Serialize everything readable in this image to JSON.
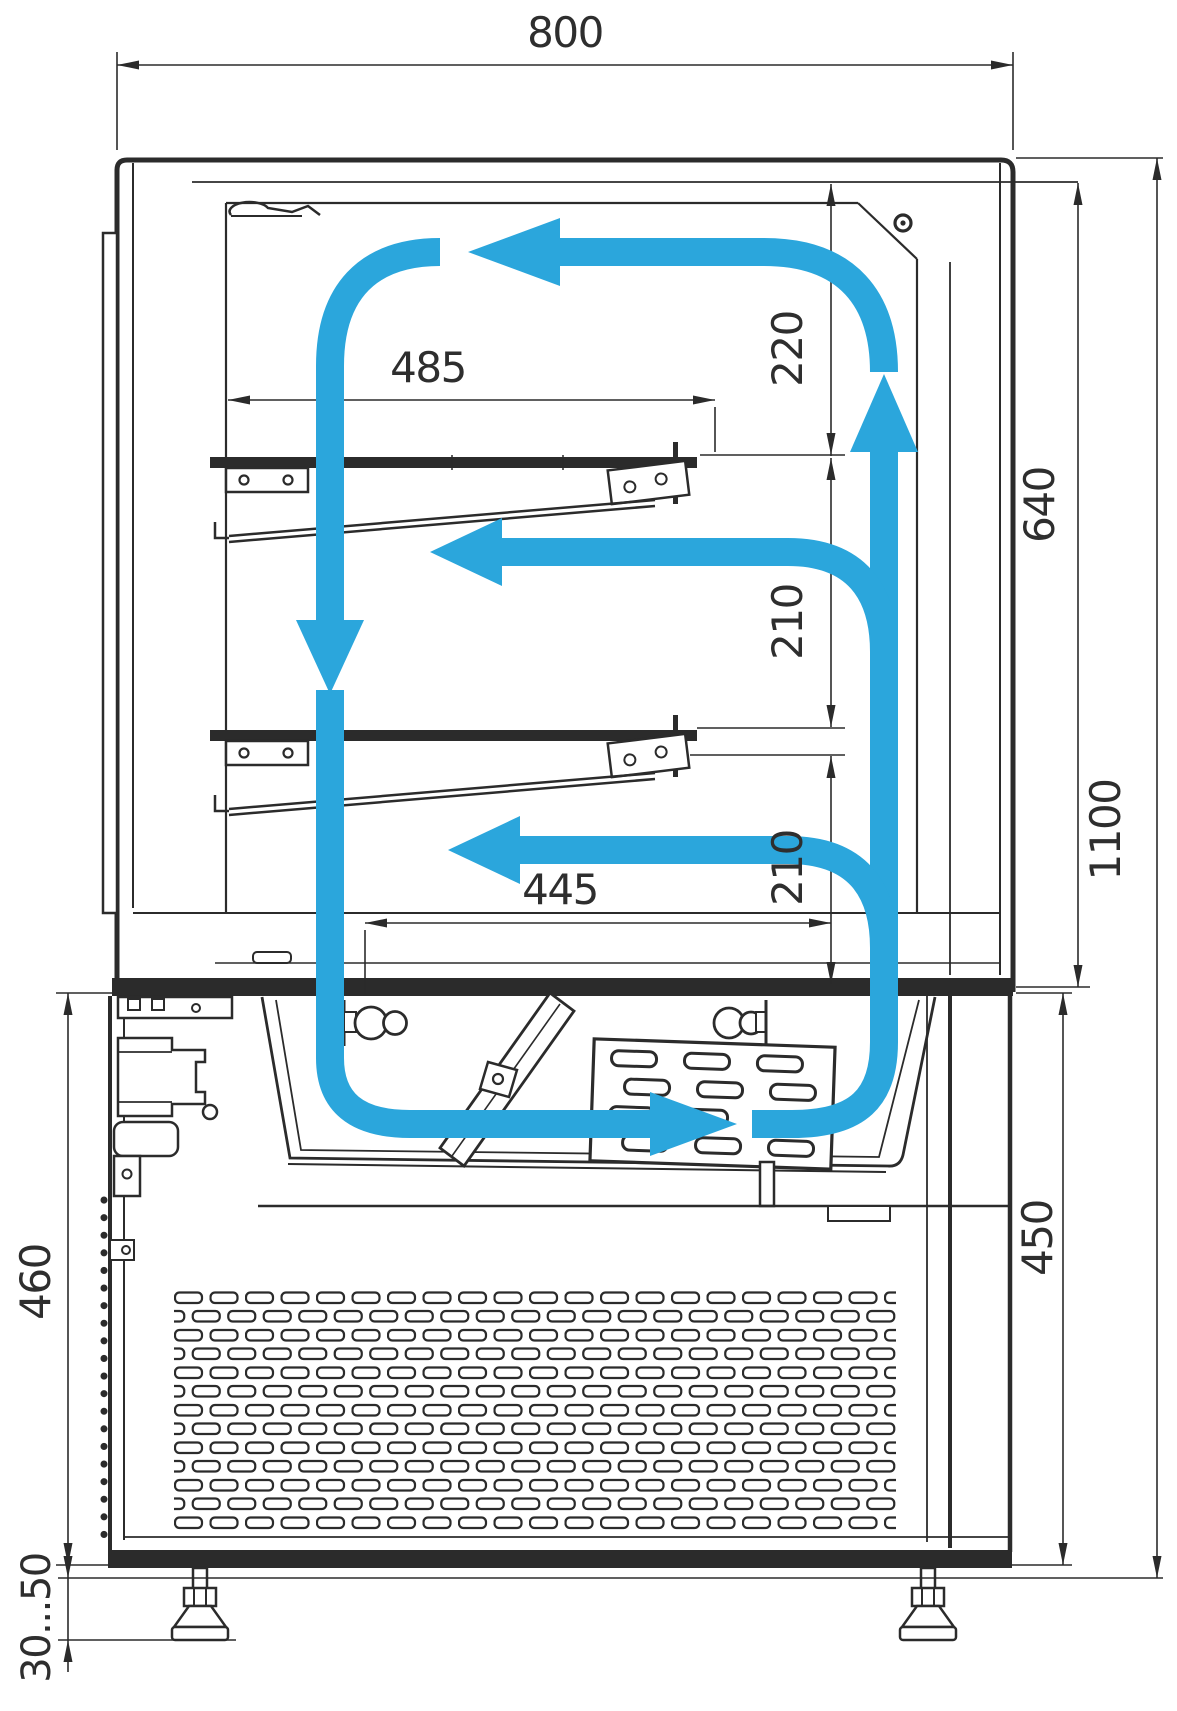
{
  "drawing": {
    "kind": "technical-section-drawing",
    "subject": "refrigerated confectionery display case with air circulation loop",
    "units": "mm",
    "canvas": {
      "width": 1177,
      "height": 1711,
      "background": "#ffffff"
    },
    "colors": {
      "line": "#2b2b2b",
      "airflow": "#2ba6dc",
      "text": "#2e2e2e"
    },
    "dimensions": {
      "overall_width": "800",
      "overall_height": "1100",
      "display_chamber_height": "640",
      "upper_shelf_depth": "485",
      "lower_deck_depth": "445",
      "top_to_upper_shelf_gap": "220",
      "upper_to_lower_shelf_gap": "210",
      "lower_shelf_to_deck_gap": "210",
      "base_unit_height_right": "450",
      "base_unit_height_left": "460",
      "leg_adjustment_range": "30...50"
    },
    "airflow_arrows": [
      "left-along-ceiling",
      "down-rear-channel",
      "left-over-upper-shelf",
      "left-over-lower-shelf",
      "right-through-evaporator",
      "up-front-channel"
    ]
  }
}
